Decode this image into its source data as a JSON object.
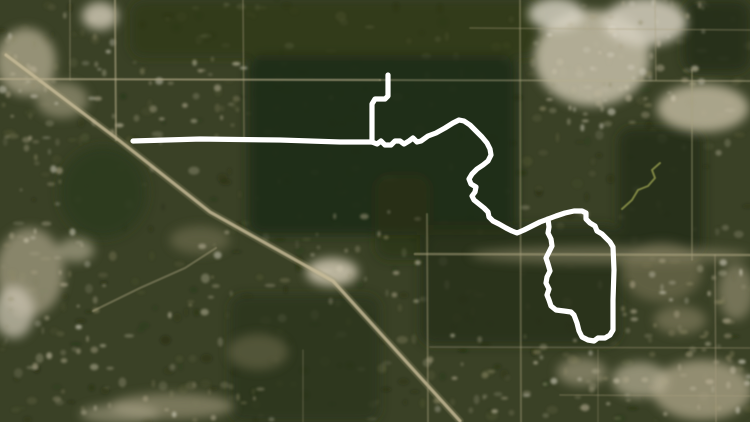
{
  "title": "Satellite map with white GPS route overlay",
  "canvas": {
    "width": 750,
    "height": 422
  },
  "palette": {
    "base": "#3a4126",
    "route": "#ffffff",
    "road": "#c8bb98",
    "road_soft": "#b0a784",
    "creek": "#9aa050",
    "speckle_dark": "#1b250f",
    "speckle_mid": "#5d6038",
    "speckle_light": "#8f8a66",
    "speckle_bright": "#cfc7ae"
  },
  "route": {
    "color": "#ffffff",
    "width": 5.2,
    "segments": [
      {
        "name": "north-stub",
        "points": [
          [
            388,
            75
          ],
          [
            388,
            96
          ],
          [
            385,
            99
          ],
          [
            375,
            99
          ],
          [
            372,
            104
          ],
          [
            372,
            142
          ]
        ]
      },
      {
        "name": "west-straightaway",
        "points": [
          [
            133,
            141
          ],
          [
            200,
            139
          ],
          [
            280,
            140
          ],
          [
            340,
            142
          ],
          [
            372,
            142
          ]
        ]
      },
      {
        "name": "forest-wiggle",
        "points": [
          [
            372,
            142
          ],
          [
            377,
            144
          ],
          [
            381,
            141
          ],
          [
            385,
            145
          ],
          [
            391,
            145
          ],
          [
            395,
            141
          ],
          [
            400,
            141
          ],
          [
            404,
            144
          ],
          [
            409,
            141
          ],
          [
            413,
            138
          ],
          [
            417,
            142
          ],
          [
            421,
            141
          ],
          [
            428,
            136
          ],
          [
            436,
            133
          ],
          [
            445,
            128
          ],
          [
            453,
            123
          ],
          [
            459,
            120
          ],
          [
            464,
            121
          ],
          [
            470,
            125
          ],
          [
            476,
            131
          ],
          [
            482,
            137
          ],
          [
            487,
            143
          ],
          [
            490,
            149
          ],
          [
            491,
            155
          ],
          [
            488,
            161
          ],
          [
            483,
            165
          ],
          [
            477,
            169
          ],
          [
            472,
            174
          ],
          [
            469,
            179
          ],
          [
            471,
            184
          ],
          [
            476,
            187
          ],
          [
            475,
            192
          ],
          [
            472,
            196
          ],
          [
            474,
            200
          ],
          [
            479,
            204
          ],
          [
            484,
            208
          ],
          [
            488,
            212
          ],
          [
            489,
            217
          ],
          [
            493,
            221
          ],
          [
            499,
            224
          ],
          [
            506,
            228
          ],
          [
            512,
            231
          ],
          [
            517,
            233
          ],
          [
            524,
            230
          ],
          [
            532,
            226
          ],
          [
            540,
            222
          ],
          [
            548,
            219
          ]
        ]
      },
      {
        "name": "east-loop",
        "points": [
          [
            548,
            219
          ],
          [
            556,
            216
          ],
          [
            565,
            213
          ],
          [
            574,
            211
          ],
          [
            582,
            211
          ],
          [
            586,
            213
          ],
          [
            586,
            219
          ],
          [
            590,
            223
          ],
          [
            595,
            226
          ],
          [
            597,
            231
          ],
          [
            602,
            234
          ],
          [
            606,
            238
          ],
          [
            610,
            242
          ],
          [
            613,
            247
          ],
          [
            614,
            270
          ],
          [
            613,
            300
          ],
          [
            613,
            330
          ],
          [
            610,
            335
          ],
          [
            605,
            338
          ],
          [
            598,
            338
          ],
          [
            594,
            341
          ],
          [
            588,
            340
          ],
          [
            582,
            337
          ],
          [
            579,
            331
          ],
          [
            577,
            323
          ],
          [
            574,
            315
          ],
          [
            571,
            312
          ],
          [
            564,
            311
          ],
          [
            556,
            310
          ],
          [
            551,
            306
          ],
          [
            549,
            300
          ],
          [
            547,
            295
          ],
          [
            549,
            289
          ],
          [
            546,
            283
          ],
          [
            547,
            277
          ],
          [
            550,
            271
          ],
          [
            548,
            264
          ],
          [
            546,
            258
          ],
          [
            549,
            252
          ],
          [
            552,
            246
          ],
          [
            551,
            239
          ],
          [
            548,
            233
          ],
          [
            549,
            227
          ],
          [
            548,
            219
          ]
        ]
      }
    ]
  },
  "roads": [
    {
      "name": "diagonal-highway-halo",
      "points": [
        [
          6,
          55
        ],
        [
          120,
          141
        ],
        [
          210,
          212
        ],
        [
          333,
          281
        ],
        [
          460,
          421
        ]
      ],
      "width": 7.5,
      "color": "#9a9271",
      "opacity": 0.28
    },
    {
      "name": "diagonal-highway",
      "points": [
        [
          6,
          55
        ],
        [
          120,
          141
        ],
        [
          210,
          212
        ],
        [
          333,
          281
        ],
        [
          460,
          421
        ]
      ],
      "width": 3.2,
      "color": "#c8bb98",
      "opacity": 0.8
    },
    {
      "name": "h-road-west",
      "points": [
        [
          0,
          79
        ],
        [
          380,
          80
        ]
      ],
      "width": 2.2,
      "color": "#b7ae8c",
      "opacity": 0.6
    },
    {
      "name": "h-road-east",
      "points": [
        [
          380,
          80
        ],
        [
          750,
          81
        ]
      ],
      "width": 2.0,
      "color": "#b7ae8c",
      "opacity": 0.4
    },
    {
      "name": "h-road-mid-east",
      "points": [
        [
          415,
          254
        ],
        [
          750,
          255
        ]
      ],
      "width": 2.6,
      "color": "#b0a784",
      "opacity": 0.5
    },
    {
      "name": "h-road-top-faint",
      "points": [
        [
          470,
          28
        ],
        [
          750,
          30
        ]
      ],
      "width": 1.8,
      "color": "#a89f7e",
      "opacity": 0.3
    },
    {
      "name": "v-road-115",
      "points": [
        [
          115,
          0
        ],
        [
          116,
          140
        ]
      ],
      "width": 2.2,
      "color": "#b7ae8c",
      "opacity": 0.5
    },
    {
      "name": "v-road-70",
      "points": [
        [
          70,
          0
        ],
        [
          70,
          80
        ]
      ],
      "width": 1.8,
      "color": "#a89f7e",
      "opacity": 0.3
    },
    {
      "name": "v-road-243",
      "points": [
        [
          243,
          0
        ],
        [
          244,
          140
        ]
      ],
      "width": 1.8,
      "color": "#a89f7e",
      "opacity": 0.35
    },
    {
      "name": "v-road-520",
      "points": [
        [
          520,
          0
        ],
        [
          521,
          422
        ]
      ],
      "width": 2.0,
      "color": "#a89f7e",
      "opacity": 0.4
    },
    {
      "name": "v-road-427",
      "points": [
        [
          427,
          214
        ],
        [
          428,
          422
        ]
      ],
      "width": 2.0,
      "color": "#a89f7e",
      "opacity": 0.4
    },
    {
      "name": "v-road-692",
      "points": [
        [
          692,
          70
        ],
        [
          692,
          260
        ]
      ],
      "width": 1.8,
      "color": "#a89f7e",
      "opacity": 0.4
    },
    {
      "name": "v-road-715",
      "points": [
        [
          715,
          255
        ],
        [
          716,
          422
        ]
      ],
      "width": 1.8,
      "color": "#a89f7e",
      "opacity": 0.35
    },
    {
      "name": "v-road-655",
      "points": [
        [
          655,
          0
        ],
        [
          656,
          80
        ]
      ],
      "width": 1.8,
      "color": "#a89f7e",
      "opacity": 0.3
    },
    {
      "name": "curve-spur",
      "points": [
        [
          93,
          311
        ],
        [
          140,
          288
        ],
        [
          185,
          268
        ],
        [
          216,
          248
        ]
      ],
      "width": 2.2,
      "color": "#b0a784",
      "opacity": 0.4
    },
    {
      "name": "h-road-347",
      "points": [
        [
          430,
          347
        ],
        [
          750,
          348
        ]
      ],
      "width": 1.8,
      "color": "#a89f7e",
      "opacity": 0.3
    },
    {
      "name": "h-road-395",
      "points": [
        [
          560,
          395
        ],
        [
          750,
          396
        ]
      ],
      "width": 1.8,
      "color": "#a89f7e",
      "opacity": 0.3
    },
    {
      "name": "v-road-303",
      "points": [
        [
          303,
          350
        ],
        [
          303,
          422
        ]
      ],
      "width": 1.6,
      "color": "#a89f7e",
      "opacity": 0.25
    },
    {
      "name": "v-road-598",
      "points": [
        [
          598,
          350
        ],
        [
          598,
          422
        ]
      ],
      "width": 1.6,
      "color": "#a89f7e",
      "opacity": 0.25
    }
  ],
  "creek": {
    "name": "creek-trail",
    "points": [
      [
        622,
        209
      ],
      [
        632,
        200
      ],
      [
        638,
        190
      ],
      [
        648,
        186
      ],
      [
        655,
        178
      ],
      [
        652,
        170
      ],
      [
        660,
        163
      ]
    ],
    "width": 2.0,
    "color": "#9aa050",
    "opacity": 0.75
  },
  "forest_patches": [
    {
      "name": "central-forest",
      "shape": "rect",
      "x": 248,
      "y": 55,
      "w": 268,
      "h": 180,
      "fill": "#212b14",
      "opacity": 0.92
    },
    {
      "name": "loop-forest",
      "shape": "rect",
      "x": 420,
      "y": 225,
      "w": 200,
      "h": 120,
      "fill": "#27311a",
      "opacity": 0.8
    },
    {
      "name": "west-grove",
      "shape": "ellipse",
      "cx": 103,
      "cy": 192,
      "rx": 44,
      "ry": 46,
      "fill": "#2c3c1d",
      "opacity": 0.9
    },
    {
      "name": "north-strip",
      "shape": "rect",
      "x": 130,
      "y": 0,
      "w": 410,
      "h": 58,
      "fill": "#2c3619",
      "opacity": 0.6
    },
    {
      "name": "northeast-corner-forest",
      "shape": "rect",
      "x": 683,
      "y": 0,
      "w": 67,
      "h": 72,
      "fill": "#263016",
      "opacity": 0.85
    },
    {
      "name": "east-forest",
      "shape": "rect",
      "x": 618,
      "y": 128,
      "w": 85,
      "h": 130,
      "fill": "#242e15",
      "opacity": 0.85
    },
    {
      "name": "south-central-forest",
      "shape": "rect",
      "x": 230,
      "y": 295,
      "w": 150,
      "h": 127,
      "fill": "#2a3418",
      "opacity": 0.7
    },
    {
      "name": "mid-forest-wedge",
      "shape": "rect",
      "x": 375,
      "y": 175,
      "w": 55,
      "h": 85,
      "fill": "#2a3418",
      "opacity": 0.6
    }
  ],
  "bright_patches": [
    {
      "cx": 592,
      "cy": 58,
      "rx": 58,
      "ry": 48,
      "fill": "#c7bfa9",
      "opacity": 0.85
    },
    {
      "cx": 645,
      "cy": 22,
      "rx": 42,
      "ry": 24,
      "fill": "#d5cfbe",
      "opacity": 0.85
    },
    {
      "cx": 703,
      "cy": 108,
      "rx": 46,
      "ry": 24,
      "fill": "#c6bda4",
      "opacity": 0.8
    },
    {
      "cx": 556,
      "cy": 14,
      "rx": 28,
      "ry": 16,
      "fill": "#dcd7c8",
      "opacity": 0.8
    },
    {
      "cx": 26,
      "cy": 62,
      "rx": 30,
      "ry": 34,
      "fill": "#b4ac92",
      "opacity": 0.75
    },
    {
      "cx": 62,
      "cy": 100,
      "rx": 26,
      "ry": 18,
      "fill": "#a9a186",
      "opacity": 0.6
    },
    {
      "cx": 100,
      "cy": 16,
      "rx": 18,
      "ry": 14,
      "fill": "#ccc5b2",
      "opacity": 0.85
    },
    {
      "cx": 30,
      "cy": 272,
      "rx": 34,
      "ry": 44,
      "fill": "#aaa287",
      "opacity": 0.7
    },
    {
      "cx": 14,
      "cy": 312,
      "rx": 20,
      "ry": 26,
      "fill": "#cbc4b1",
      "opacity": 0.75
    },
    {
      "cx": 76,
      "cy": 250,
      "rx": 18,
      "ry": 12,
      "fill": "#bdb59b",
      "opacity": 0.6
    },
    {
      "cx": 332,
      "cy": 272,
      "rx": 26,
      "ry": 14,
      "fill": "#d0c8b2",
      "opacity": 0.85
    },
    {
      "cx": 172,
      "cy": 406,
      "rx": 62,
      "ry": 13,
      "fill": "#a39b7e",
      "opacity": 0.6
    },
    {
      "cx": 120,
      "cy": 414,
      "rx": 40,
      "ry": 10,
      "fill": "#b9b196",
      "opacity": 0.5
    },
    {
      "cx": 702,
      "cy": 390,
      "rx": 50,
      "ry": 30,
      "fill": "#b0a78b",
      "opacity": 0.75
    },
    {
      "cx": 640,
      "cy": 380,
      "rx": 28,
      "ry": 18,
      "fill": "#c2ba9f",
      "opacity": 0.65
    },
    {
      "cx": 582,
      "cy": 372,
      "rx": 25,
      "ry": 14,
      "fill": "#b2aa8e",
      "opacity": 0.55
    },
    {
      "cx": 736,
      "cy": 292,
      "rx": 18,
      "ry": 28,
      "fill": "#a59d80",
      "opacity": 0.55
    },
    {
      "cx": 680,
      "cy": 320,
      "rx": 26,
      "ry": 14,
      "fill": "#9a926f",
      "opacity": 0.5
    },
    {
      "cx": 610,
      "cy": 255,
      "rx": 140,
      "ry": 9,
      "fill": "#a59c7d",
      "opacity": 0.45
    },
    {
      "cx": 662,
      "cy": 272,
      "rx": 40,
      "ry": 30,
      "fill": "#8d8666",
      "opacity": 0.45
    },
    {
      "cx": 200,
      "cy": 240,
      "rx": 30,
      "ry": 14,
      "fill": "#8f8866",
      "opacity": 0.4
    },
    {
      "cx": 258,
      "cy": 352,
      "rx": 30,
      "ry": 18,
      "fill": "#89815f",
      "opacity": 0.4
    }
  ],
  "residential_zones": [
    {
      "x": 0,
      "y": 30,
      "w": 120,
      "h": 115,
      "density": 1.1
    },
    {
      "x": 0,
      "y": 225,
      "w": 105,
      "h": 150,
      "density": 1.0
    },
    {
      "x": 535,
      "y": 0,
      "w": 170,
      "h": 130,
      "density": 1.4
    },
    {
      "x": 618,
      "y": 255,
      "w": 132,
      "h": 167,
      "density": 1.2
    },
    {
      "x": 420,
      "y": 335,
      "w": 200,
      "h": 87,
      "density": 1.0
    },
    {
      "x": 55,
      "y": 375,
      "w": 230,
      "h": 47,
      "density": 0.9
    },
    {
      "x": 125,
      "y": 55,
      "w": 125,
      "h": 90,
      "density": 0.8
    },
    {
      "x": 0,
      "y": 130,
      "w": 60,
      "h": 95,
      "density": 0.8
    },
    {
      "x": 150,
      "y": 230,
      "w": 85,
      "h": 100,
      "density": 0.6
    },
    {
      "x": 305,
      "y": 211,
      "w": 115,
      "h": 95,
      "density": 0.7
    }
  ],
  "speckle_count": 520
}
